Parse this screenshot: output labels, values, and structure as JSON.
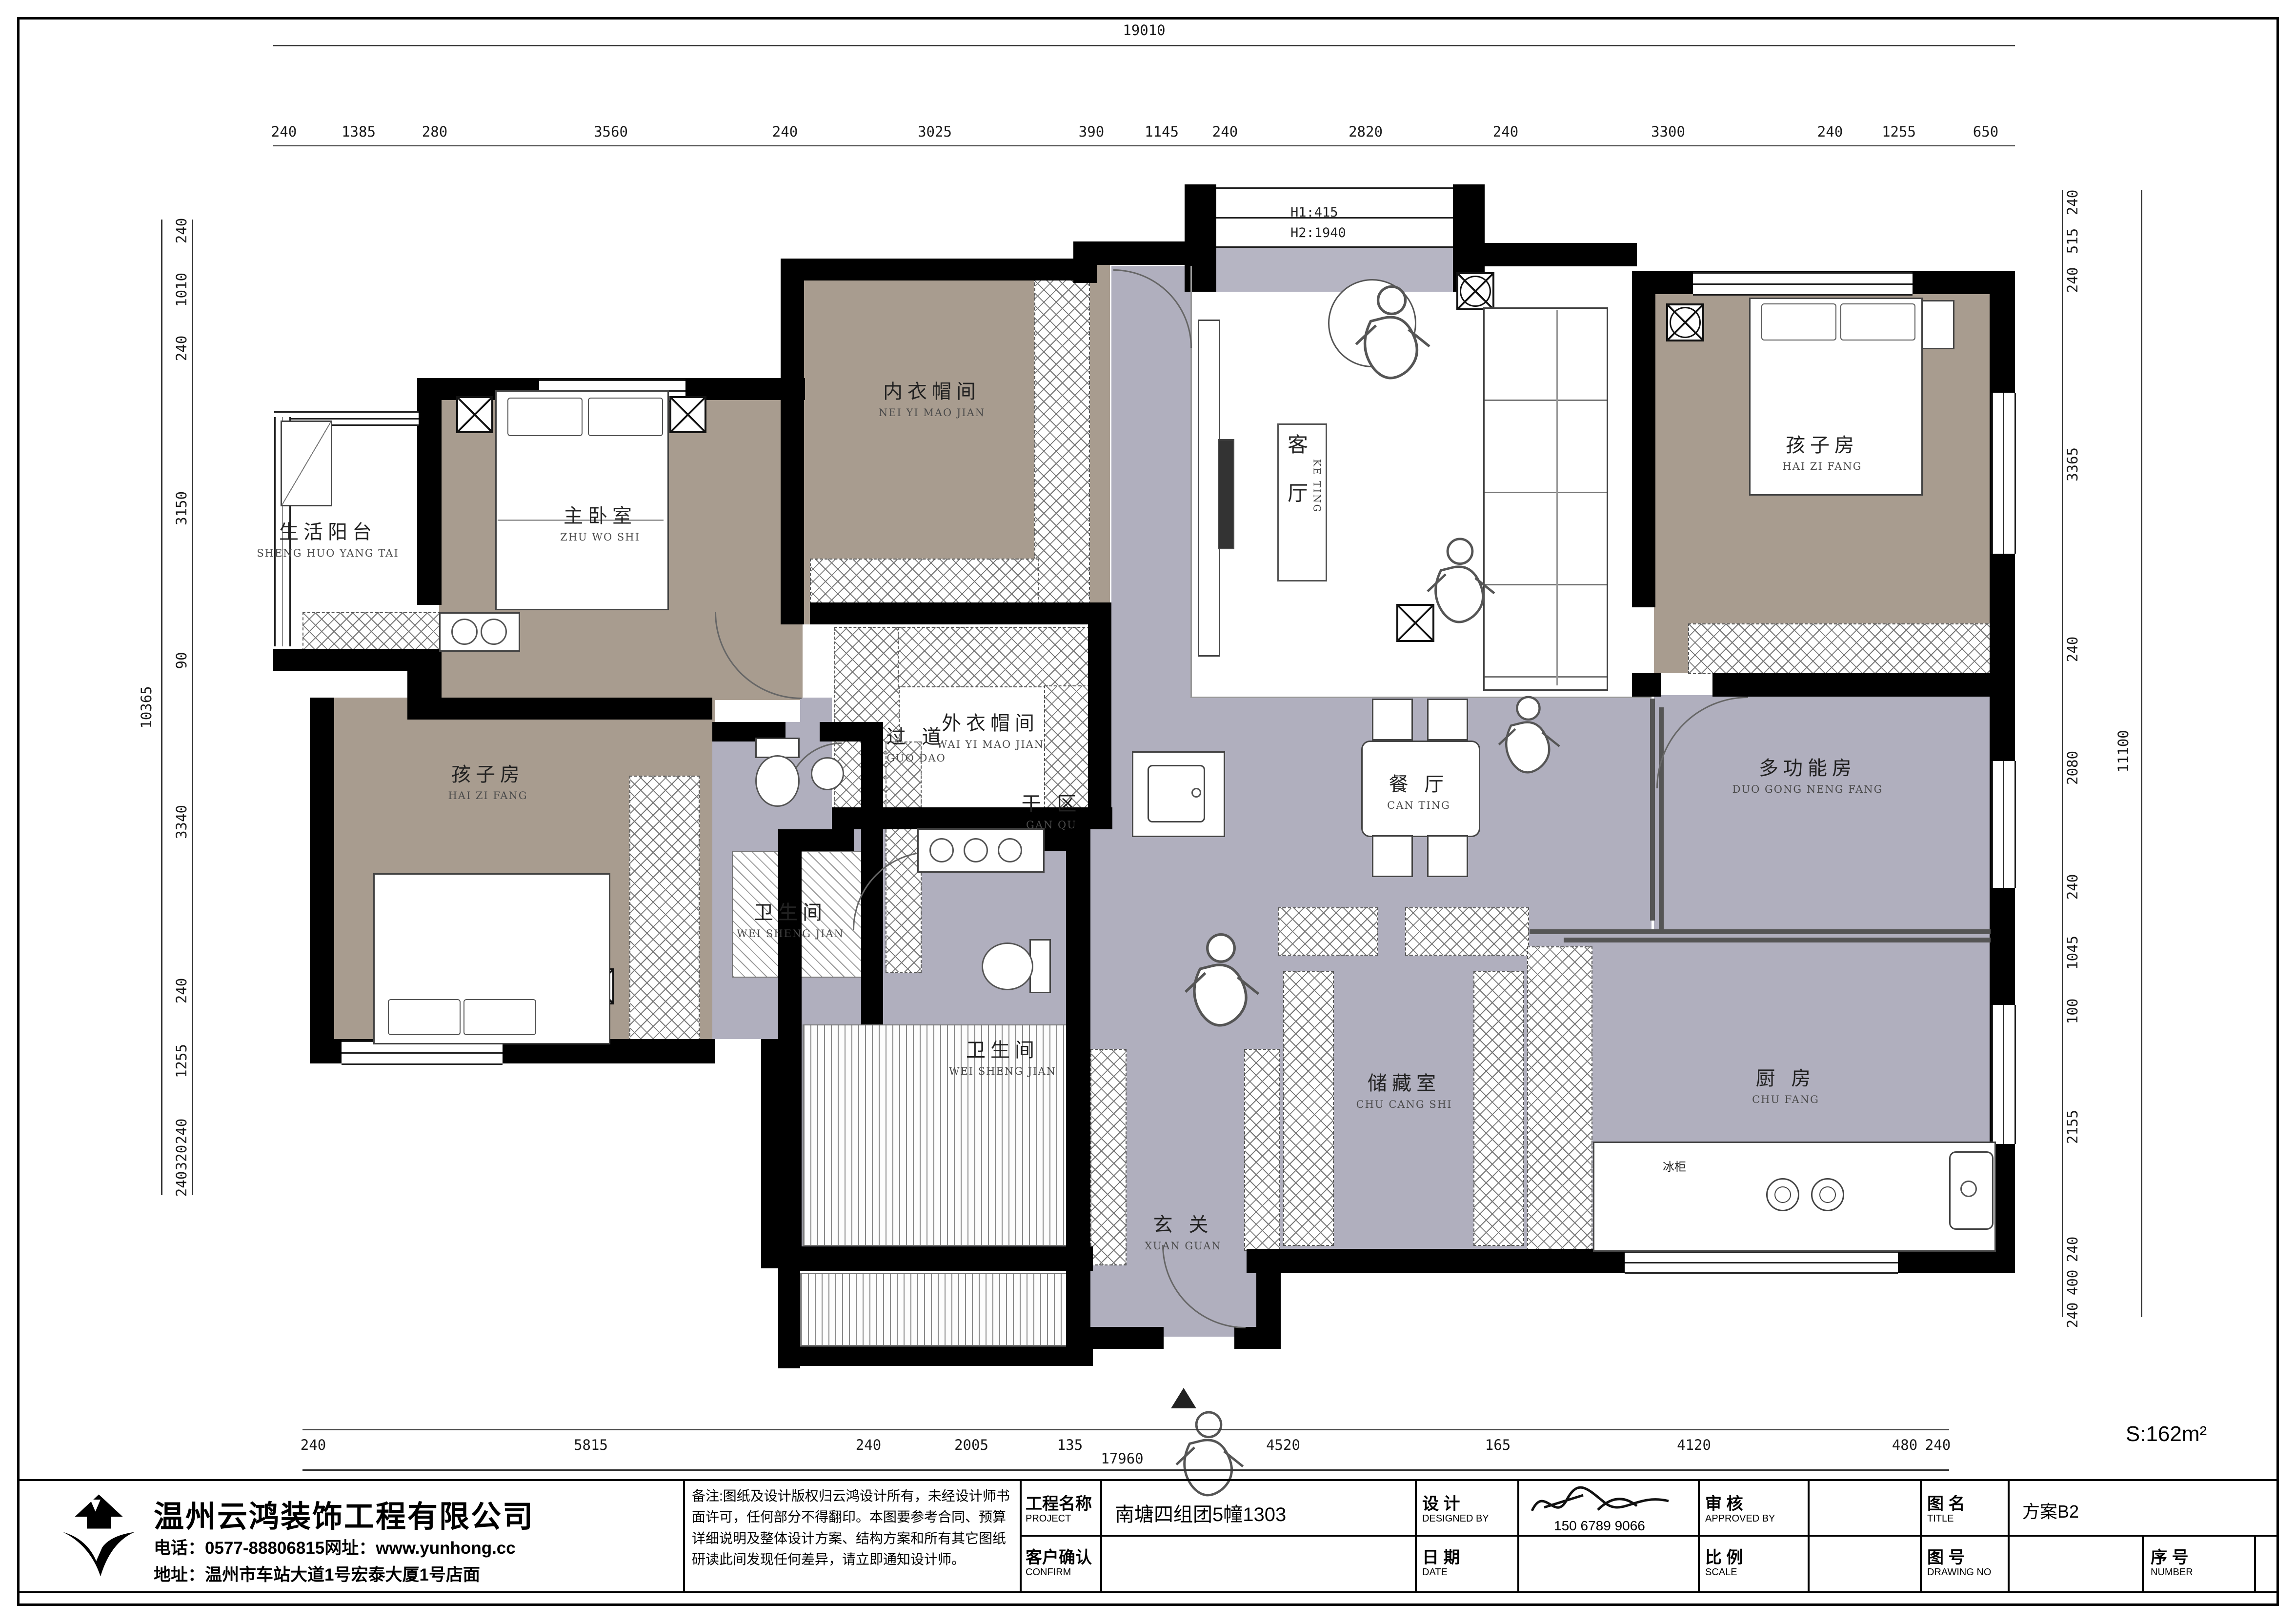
{
  "sheet": {
    "area_label": "S:162m²",
    "company": {
      "name": "温州云鸿装饰工程有限公司",
      "phone_web": "电话：0577-88806815网址：www.yunhong.cc",
      "address": "地址：温州市车站大道1号宏泰大厦1号店面"
    },
    "notes": "备注:图纸及设计版权归云鸿设计所有，未经设计师书面许可，任何部分不得翻印。本图要参考合同、预算详细说明及整体设计方案、结构方案和所有其它图纸研读此间发现任何差异，请立即通知设计师。",
    "fields": {
      "project_label": "工程名称",
      "project_label_en": "PROJECT",
      "project_value": "南塘四组团5幢1303",
      "confirm_label": "客户确认",
      "confirm_label_en": "CONFIRM",
      "design_label": "设  计",
      "design_label_en": "DESIGNED BY",
      "designer_phone": "150 6789 9066",
      "date_label": "日  期",
      "date_label_en": "DATE",
      "approve_label": "审  核",
      "approve_label_en": "APPROVED BY",
      "scale_label": "比  例",
      "scale_label_en": "SCALE",
      "title_label": "图  名",
      "title_label_en": "TITLE",
      "title_value": "方案B2",
      "drawingno_label": "图  号",
      "drawingno_label_en": "DRAWING NO",
      "number_label": "序  号",
      "number_label_en": "NUMBER"
    }
  },
  "rooms": [
    {
      "zh": "生活阳台",
      "py": "SHENG HUO YANG TAI"
    },
    {
      "zh": "主卧室",
      "py": "ZHU WO SHI"
    },
    {
      "zh": "内衣帽间",
      "py": "NEI YI MAO JIAN"
    },
    {
      "zh": "外衣帽间",
      "py": "WAI YI MAO JIAN"
    },
    {
      "zh": "客 厅",
      "py": "KE TING"
    },
    {
      "zh": "孩子房",
      "py": "HAI ZI FANG"
    },
    {
      "zh": "孩子房",
      "py": "HAI ZI FANG"
    },
    {
      "zh": "过 道",
      "py": "GUO DAO"
    },
    {
      "zh": "餐 厅",
      "py": "CAN TING"
    },
    {
      "zh": "多功能房",
      "py": "DUO GONG NENG FANG"
    },
    {
      "zh": "干 区",
      "py": "GAN QU"
    },
    {
      "zh": "卫生间",
      "py": "WEI SHENG JIAN"
    },
    {
      "zh": "卫生间",
      "py": "WEI SHENG JIAN"
    },
    {
      "zh": "玄 关",
      "py": "XUAN GUAN"
    },
    {
      "zh": "储藏室",
      "py": "CHU CANG SHI"
    },
    {
      "zh": "厨 房",
      "py": "CHU FANG"
    }
  ],
  "annotations": {
    "h1": "H1:415",
    "h2": "H2:1940",
    "fridge": "冰柜"
  },
  "dims": {
    "top_total": "19010",
    "bottom_total": "17960",
    "left_total": "10365",
    "right_total": "11100",
    "top": [
      "240",
      "1385",
      "280",
      "3560",
      "240",
      "3025",
      "390",
      "1145",
      "240",
      "2820",
      "240",
      "3300",
      "240",
      "1255",
      "650"
    ],
    "left": [
      "240",
      "1010",
      "240",
      "3150",
      "90",
      "3340",
      "240",
      "1255",
      "240",
      "320",
      "240"
    ],
    "right": [
      "240",
      "515",
      "240",
      "3365",
      "240",
      "2080",
      "240",
      "1045",
      "100",
      "2155",
      "240",
      "400",
      "240"
    ],
    "bottom": [
      "240",
      "5815",
      "240",
      "2005",
      "135",
      "4520",
      "165",
      "4120",
      "480",
      "240"
    ]
  }
}
